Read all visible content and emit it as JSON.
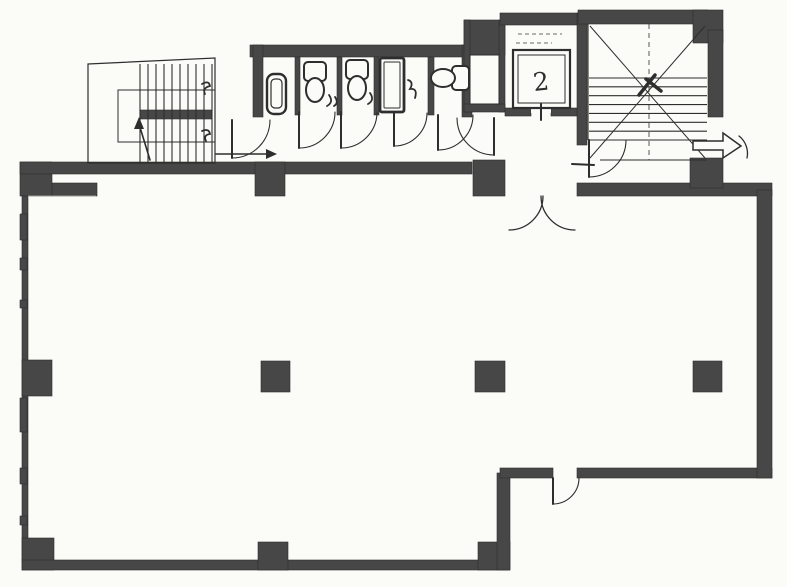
{
  "document": {
    "kind": "scanned architectural floor plan",
    "visible_text_note": "only legible handwritten mark is the digit 2 inside the elevator car; other marks are illegible scribbles"
  },
  "colors": {
    "paper": "#fbfbf8",
    "ink": "#2e2e2e",
    "wall": "#474747",
    "faint": "#9a9a96"
  },
  "plan": {
    "width": 787,
    "height": 587,
    "wall_rects": [
      {
        "n": "top-left-corner-block",
        "x": 20,
        "y": 162,
        "w": 32,
        "h": 34
      },
      {
        "n": "top-left-ledge",
        "x": 52,
        "y": 183,
        "w": 45,
        "h": 13
      },
      {
        "n": "top-wall-left",
        "x": 20,
        "y": 162,
        "w": 452,
        "h": 12
      },
      {
        "n": "top-wall-column",
        "x": 255,
        "y": 162,
        "w": 30,
        "h": 34
      },
      {
        "n": "mid-top-pier",
        "x": 473,
        "y": 160,
        "w": 32,
        "h": 36
      },
      {
        "n": "top-wall-right",
        "x": 577,
        "y": 183,
        "w": 195,
        "h": 13
      },
      {
        "n": "toilet-top-wall",
        "x": 250,
        "y": 45,
        "w": 222,
        "h": 12
      },
      {
        "n": "toilet-left-wall",
        "x": 253,
        "y": 45,
        "w": 10,
        "h": 72
      },
      {
        "n": "toilet-right-wall",
        "x": 462,
        "y": 45,
        "w": 10,
        "h": 72
      },
      {
        "n": "stall-divider-1",
        "x": 295,
        "y": 57,
        "w": 5,
        "h": 58
      },
      {
        "n": "stall-divider-2",
        "x": 337,
        "y": 57,
        "w": 5,
        "h": 58
      },
      {
        "n": "stall-divider-3",
        "x": 374,
        "y": 57,
        "w": 5,
        "h": 58
      },
      {
        "n": "stall-divider-4",
        "x": 428,
        "y": 57,
        "w": 6,
        "h": 58
      },
      {
        "n": "shaft-top-block",
        "x": 464,
        "y": 20,
        "w": 41,
        "h": 35
      },
      {
        "n": "shaft-left-wall",
        "x": 464,
        "y": 20,
        "w": 6,
        "h": 92
      },
      {
        "n": "shaft-right-wall",
        "x": 499,
        "y": 20,
        "w": 6,
        "h": 92
      },
      {
        "n": "shaft-bottom-wall",
        "x": 464,
        "y": 104,
        "w": 41,
        "h": 8
      },
      {
        "n": "elevator-top-wall",
        "x": 500,
        "y": 13,
        "w": 87,
        "h": 12
      },
      {
        "n": "elevator-right-wall",
        "x": 577,
        "y": 13,
        "w": 10,
        "h": 132
      },
      {
        "n": "elevator-front-wall-left",
        "x": 505,
        "y": 108,
        "w": 26,
        "h": 8
      },
      {
        "n": "elevator-front-wall-right",
        "x": 551,
        "y": 108,
        "w": 26,
        "h": 8
      },
      {
        "n": "stair2-top-wall",
        "x": 578,
        "y": 10,
        "w": 130,
        "h": 14
      },
      {
        "n": "stair2-corner-block",
        "x": 693,
        "y": 10,
        "w": 30,
        "h": 33
      },
      {
        "n": "stair2-right-wall",
        "x": 708,
        "y": 30,
        "w": 15,
        "h": 87
      },
      {
        "n": "stair2-lower-block",
        "x": 690,
        "y": 158,
        "w": 33,
        "h": 30
      },
      {
        "n": "left-wall",
        "x": 22,
        "y": 196,
        "w": 6,
        "h": 364
      },
      {
        "n": "left-wall-column",
        "x": 22,
        "y": 360,
        "w": 30,
        "h": 36
      },
      {
        "n": "bottom-left-corner-block",
        "x": 22,
        "y": 538,
        "w": 32,
        "h": 32
      },
      {
        "n": "bottom-wall",
        "x": 22,
        "y": 560,
        "w": 486,
        "h": 10
      },
      {
        "n": "bottom-wall-column",
        "x": 258,
        "y": 542,
        "w": 30,
        "h": 28
      },
      {
        "n": "step-corner-column",
        "x": 478,
        "y": 542,
        "w": 32,
        "h": 28
      },
      {
        "n": "step-vertical-wall",
        "x": 497,
        "y": 473,
        "w": 13,
        "h": 97
      },
      {
        "n": "notch-wall-left",
        "x": 500,
        "y": 468,
        "w": 53,
        "h": 10
      },
      {
        "n": "notch-wall-right",
        "x": 577,
        "y": 468,
        "w": 195,
        "h": 10
      },
      {
        "n": "right-wall",
        "x": 757,
        "y": 190,
        "w": 15,
        "h": 288
      },
      {
        "n": "free-column-a",
        "x": 261,
        "y": 361,
        "w": 29,
        "h": 31
      },
      {
        "n": "free-column-b",
        "x": 475,
        "y": 361,
        "w": 30,
        "h": 31
      },
      {
        "n": "free-column-c",
        "x": 693,
        "y": 361,
        "w": 29,
        "h": 31
      },
      {
        "n": "stair1-landing-bar",
        "x": 140,
        "y": 110,
        "w": 72,
        "h": 9
      },
      {
        "n": "left-wall-dash",
        "x": 20,
        "y": 214,
        "w": 7,
        "h": 26
      },
      {
        "n": "left-wall-dash",
        "x": 20,
        "y": 258,
        "w": 7,
        "h": 12
      },
      {
        "n": "left-wall-dash",
        "x": 20,
        "y": 300,
        "w": 7,
        "h": 8
      },
      {
        "n": "left-wall-dash",
        "x": 20,
        "y": 398,
        "w": 7,
        "h": 34
      },
      {
        "n": "left-wall-dash",
        "x": 20,
        "y": 468,
        "w": 7,
        "h": 16
      },
      {
        "n": "left-wall-dash",
        "x": 20,
        "y": 516,
        "w": 7,
        "h": 9
      }
    ],
    "white_rects": [
      {
        "n": "elevator-door-gap",
        "x": 531,
        "y": 101,
        "w": 20,
        "h": 12
      }
    ],
    "outlines": [
      {
        "n": "stair1-outer-outline",
        "points": [
          [
            88,
            64
          ],
          [
            215,
            58
          ],
          [
            215,
            163
          ],
          [
            88,
            163
          ]
        ],
        "close": true,
        "w": 1.2
      }
    ],
    "rects": [
      {
        "n": "stair1-inner-outline",
        "x": 118,
        "y": 90,
        "w": 97,
        "h": 52,
        "sw": 1,
        "fill": "none",
        "rx": 0
      },
      {
        "n": "shaft-inner-box",
        "x": 470,
        "y": 55,
        "w": 29,
        "h": 49,
        "sw": 1,
        "fill": "paper",
        "rx": 0
      },
      {
        "n": "elevator-car-outer",
        "x": 513,
        "y": 50,
        "w": 57,
        "h": 58,
        "sw": 2.2,
        "fill": "paper",
        "rx": 0
      },
      {
        "n": "elevator-car-inner",
        "x": 518,
        "y": 55,
        "w": 47,
        "h": 48,
        "sw": 1,
        "fill": "none",
        "rx": 0
      },
      {
        "n": "urinal-outer",
        "x": 267,
        "y": 74,
        "w": 19,
        "h": 40,
        "sw": 2.4,
        "fill": "paper",
        "rx": 7
      },
      {
        "n": "urinal-inner",
        "x": 271,
        "y": 79,
        "w": 11,
        "h": 29,
        "sw": 1.2,
        "fill": "none",
        "rx": 4
      },
      {
        "n": "toilet1-tank",
        "x": 304,
        "y": 62,
        "w": 22,
        "h": 19,
        "sw": 2,
        "fill": "paper",
        "rx": 4
      },
      {
        "n": "toilet2-tank",
        "x": 346,
        "y": 60,
        "w": 22,
        "h": 19,
        "sw": 2,
        "fill": "paper",
        "rx": 4
      },
      {
        "n": "cleaning-sink-outer",
        "x": 380,
        "y": 58,
        "w": 24,
        "h": 54,
        "sw": 2.8,
        "fill": "paper",
        "rx": 2
      },
      {
        "n": "cleaning-sink-inner",
        "x": 384,
        "y": 62,
        "w": 16,
        "h": 46,
        "sw": 1,
        "fill": "none",
        "rx": 1
      },
      {
        "n": "toilet3-tank",
        "x": 452,
        "y": 66,
        "w": 17,
        "h": 24,
        "sw": 2,
        "fill": "paper",
        "rx": 4
      }
    ],
    "ellipses": [
      {
        "n": "toilet1-bowl",
        "cx": 315,
        "cy": 90,
        "rx": 9,
        "ry": 12,
        "sw": 2
      },
      {
        "n": "toilet2-bowl",
        "cx": 357,
        "cy": 88,
        "rx": 9,
        "ry": 12,
        "sw": 2
      },
      {
        "n": "toilet3-bowl",
        "cx": 443,
        "cy": 78,
        "rx": 12,
        "ry": 9,
        "sw": 2
      }
    ],
    "stairs": [
      {
        "n": "stair1-treads",
        "x": 140,
        "y": 64,
        "w": 72,
        "h": 98,
        "count": 10,
        "dir": "v",
        "sw": 1.1
      },
      {
        "n": "stair2-treads",
        "x": 589,
        "y": 78,
        "w": 118,
        "h": 62,
        "count": 8,
        "dir": "h",
        "sw": 1.1
      }
    ],
    "thin_lines": [
      {
        "n": "stair2-left-edge",
        "x1": 588,
        "y1": 24,
        "x2": 588,
        "y2": 140,
        "w": 1.1
      },
      {
        "n": "stair2-bottom-edge",
        "x1": 600,
        "y1": 160,
        "x2": 707,
        "y2": 160,
        "w": 1.1
      },
      {
        "n": "stair2-diagonal",
        "x1": 590,
        "y1": 26,
        "x2": 705,
        "y2": 158,
        "w": 1
      },
      {
        "n": "stair2-diagonal",
        "x1": 705,
        "y1": 26,
        "x2": 590,
        "y2": 158,
        "w": 1
      },
      {
        "n": "stair2-center-line",
        "x1": 649,
        "y1": 24,
        "x2": 649,
        "y2": 160,
        "w": 0.8,
        "dash": "5,4"
      },
      {
        "n": "shaft-x-brace",
        "x1": 471,
        "y1": 56,
        "x2": 498,
        "y2": 103,
        "w": 1.1
      },
      {
        "n": "shaft-x-brace",
        "x1": 498,
        "y1": 56,
        "x2": 471,
        "y2": 103,
        "w": 1.1
      },
      {
        "n": "faint-plaster-line",
        "x1": 28,
        "y1": 196,
        "x2": 96,
        "y2": 196,
        "w": 1,
        "c": "faint"
      },
      {
        "n": "elevator-label-dash",
        "x1": 518,
        "y1": 34,
        "x2": 562,
        "y2": 34,
        "w": 1.4,
        "dash": "4,3",
        "c": "faint"
      },
      {
        "n": "elevator-label-dash",
        "x1": 516,
        "y1": 43,
        "x2": 552,
        "y2": 43,
        "w": 1.4,
        "dash": "4,3",
        "c": "faint"
      }
    ],
    "paths": [
      {
        "n": "door-toilet-area-leaf",
        "d": "M 232 120 L 232 158",
        "w": 2
      },
      {
        "n": "door-toilet-area-swing",
        "d": "M 232 158 A 38 38 0 0 0 270 120",
        "w": 1.1
      },
      {
        "n": "door-stall1-leaf",
        "d": "M 299 112 L 299 148",
        "w": 2
      },
      {
        "n": "door-stall1-swing",
        "d": "M 299 148 A 36 36 0 0 0 335 112",
        "w": 1.1
      },
      {
        "n": "door-stall2-leaf",
        "d": "M 341 112 L 341 148",
        "w": 2
      },
      {
        "n": "door-stall2-swing",
        "d": "M 341 148 A 36 36 0 0 0 377 112",
        "w": 1.1
      },
      {
        "n": "door-stall3-leaf",
        "d": "M 394 113 L 394 146",
        "w": 2
      },
      {
        "n": "door-stall3-swing",
        "d": "M 394 146 A 33 33 0 0 0 427 113",
        "w": 1.1
      },
      {
        "n": "door-stall4-leaf",
        "d": "M 438 115 L 438 150",
        "w": 2
      },
      {
        "n": "door-stall4-swing",
        "d": "M 438 150 A 35 35 0 0 0 473 115",
        "w": 1.1
      },
      {
        "n": "door-lobby-leaf",
        "d": "M 494 118 L 494 155",
        "w": 2
      },
      {
        "n": "door-lobby-swing",
        "d": "M 494 155 A 37 37 0 0 1 457 118",
        "w": 1.1
      },
      {
        "n": "double-door-left-swing",
        "d": "M 543 196 A 34 34 0 0 1 509 230",
        "w": 1.3
      },
      {
        "n": "double-door-right-swing",
        "d": "M 541 196 A 34 34 0 0 0 575 230",
        "w": 1.3
      },
      {
        "n": "door-stair2-leaf",
        "d": "M 589 140 L 589 177",
        "w": 2
      },
      {
        "n": "door-stair2-swing",
        "d": "M 589 177 A 37 37 0 0 0 626 140",
        "w": 1.1
      },
      {
        "n": "door-exit-topright-swing",
        "d": "M 739 136 A 22 22 0 0 1 747 158",
        "w": 1.3
      },
      {
        "n": "door-exit-bottom-leaf",
        "d": "M 553 478 L 553 504",
        "w": 2
      },
      {
        "n": "door-exit-bottom-swing",
        "d": "M 553 504 A 26 26 0 0 0 579 478",
        "w": 1.1
      },
      {
        "n": "elevator-door-tick",
        "d": "M 541 104 L 541 120",
        "w": 2
      },
      {
        "n": "stair1-direction-line",
        "d": "M 150 160 L 139 124",
        "w": 1.6
      },
      {
        "n": "entry-arrow-line",
        "d": "M 216 154 L 266 154",
        "w": 1.6
      },
      {
        "n": "handwritten-mark",
        "d": "M 202 84 q 7 -4 8 2 q -8 2 -5 8",
        "w": 1.8
      },
      {
        "n": "handwritten-mark",
        "d": "M 202 131 q 7 -3 8 3 q -7 1 -4 7",
        "w": 1.8
      },
      {
        "n": "handwritten-mark",
        "d": "M 329 95 q 5 7 -2 11 m 8 -9 q 4 6 -1 9",
        "w": 1.8
      },
      {
        "n": "handwritten-mark",
        "d": "M 370 93 q 5 7 -2 11",
        "w": 1.8
      },
      {
        "n": "handwritten-mark",
        "d": "M 408 80 q 6 2 2 9 q 8 -1 5 9",
        "w": 1.8
      },
      {
        "n": "threshold-mark",
        "d": "M 572 164 l 22 1",
        "w": 2
      },
      {
        "n": "stair2-center-mark",
        "d": "M 639 95 L 655 75 M 646 79 L 661 91",
        "w": 3.5
      }
    ],
    "polygons": [
      {
        "n": "entry-arrowhead",
        "points": [
          [
            266,
            149
          ],
          [
            277,
            154
          ],
          [
            266,
            159
          ]
        ],
        "fill": "ink"
      },
      {
        "n": "stair1-arrowhead",
        "points": [
          [
            134,
            129
          ],
          [
            139,
            117
          ],
          [
            144,
            129
          ]
        ],
        "fill": "ink"
      },
      {
        "n": "entrance-block-arrow",
        "points": [
          [
            693,
            141
          ],
          [
            723,
            141
          ],
          [
            723,
            133
          ],
          [
            741,
            146
          ],
          [
            723,
            158
          ],
          [
            723,
            150
          ],
          [
            693,
            150
          ]
        ],
        "fill": "paper",
        "sw": 1.5
      }
    ],
    "texts": [
      {
        "n": "elevator-car-mark",
        "text": "2",
        "x": 534,
        "y": 91,
        "size": 25,
        "rot": -6
      }
    ]
  }
}
